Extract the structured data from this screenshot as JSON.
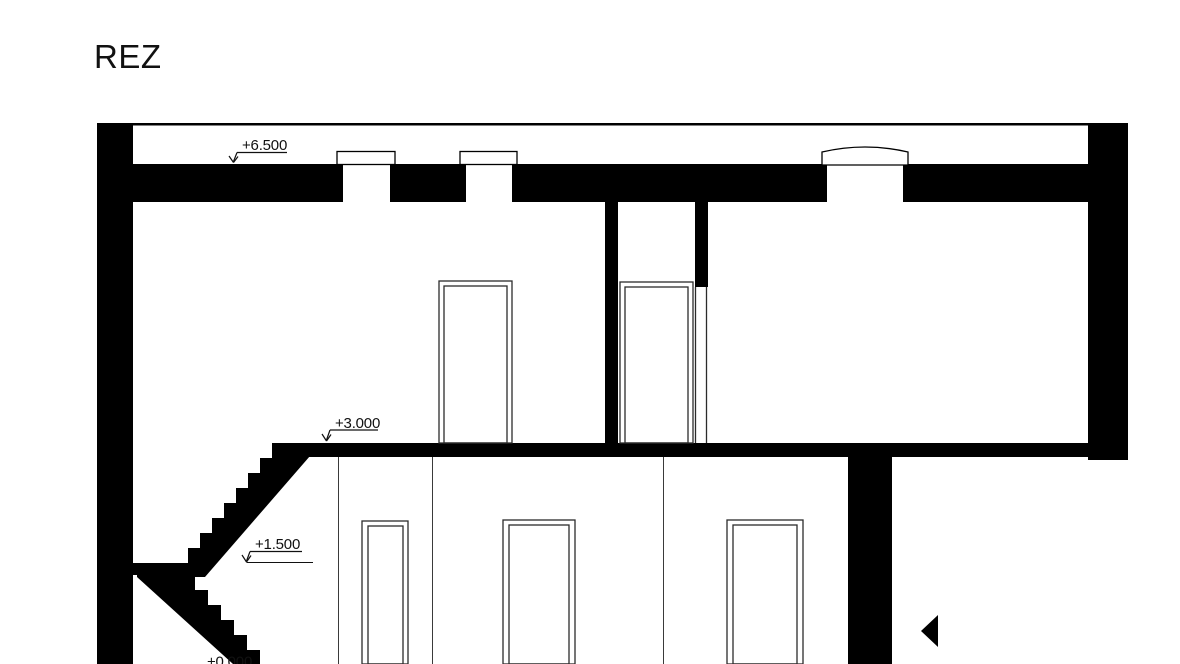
{
  "colors": {
    "ink": "#000000",
    "paper": "#ffffff",
    "thin_line": "#3a3a3a",
    "frame_line": "#2b2b2b"
  },
  "title": "REZ",
  "level_markers": [
    {
      "id": "attic-slab",
      "label": "+6.500"
    },
    {
      "id": "first-floor",
      "label": "+3.000"
    },
    {
      "id": "stair-landing",
      "label": "+1.500"
    },
    {
      "id": "ground-floor",
      "label": "+0.000"
    }
  ]
}
